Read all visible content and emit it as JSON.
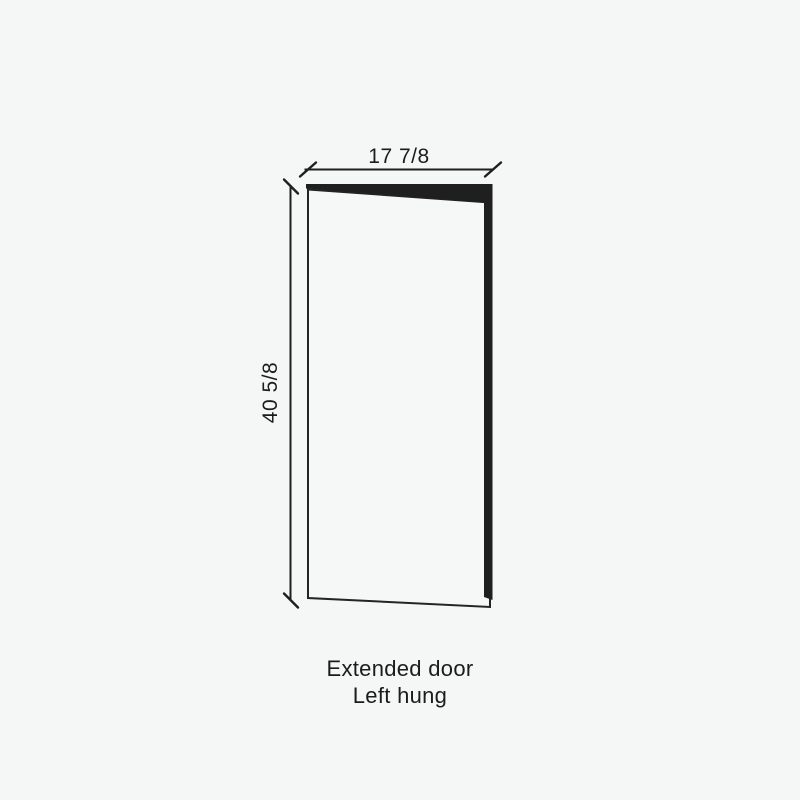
{
  "colors": {
    "background": "#f5f6f6",
    "line": "#1f1f1f",
    "door_fill": "#f6f7f7",
    "text": "#1c1c1c"
  },
  "diagram": {
    "width_dimension": {
      "label": "17 7/8"
    },
    "height_dimension": {
      "label": "40 5/8"
    },
    "caption": {
      "line1": "Extended door",
      "line2": "Left hung"
    }
  }
}
